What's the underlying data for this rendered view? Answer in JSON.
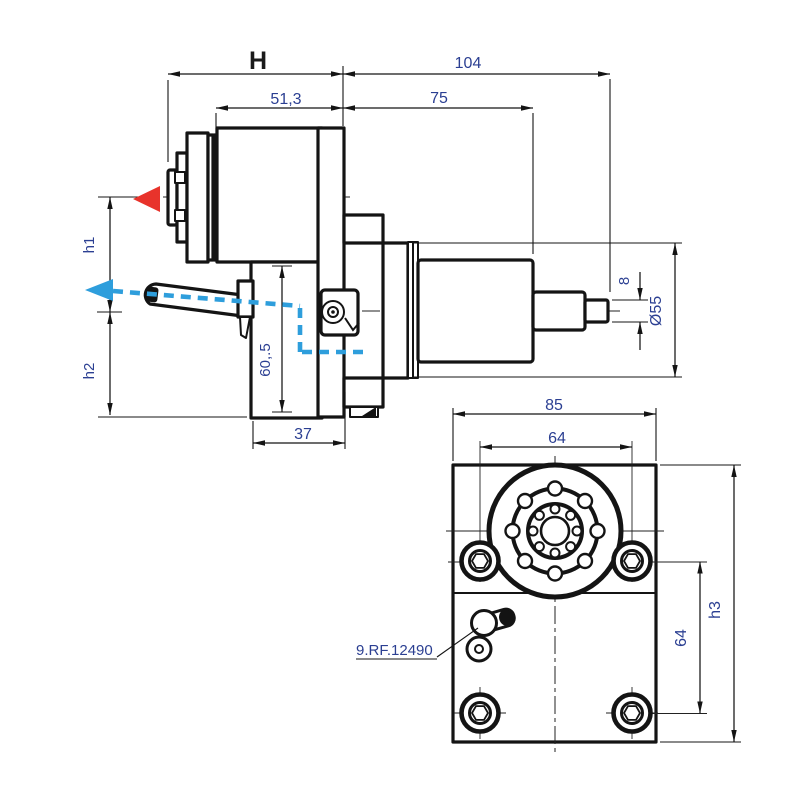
{
  "drawing_title": "tool-holder dimension drawing",
  "colors": {
    "line": "#141414",
    "dim_text": "#2b3f92",
    "red_arrow": "#e8332b",
    "blue_path": "#2e9edc"
  },
  "side_view": {
    "dims": {
      "H": "H",
      "overall_104": "104",
      "head_51_3": "51,3",
      "body_75": "75",
      "height_h1": "h1",
      "height_h2": "h2",
      "post_60_5": "60,.5",
      "post_width_37": "37",
      "tip_dia_8": "8",
      "shank_dia_55": "Ø55"
    }
  },
  "front_view": {
    "dims": {
      "width_85": "85",
      "hole_pitch_top_64": "64",
      "hole_pitch_side_64": "64",
      "height_h3": "h3"
    },
    "part_ref": "9.RF.12490"
  }
}
